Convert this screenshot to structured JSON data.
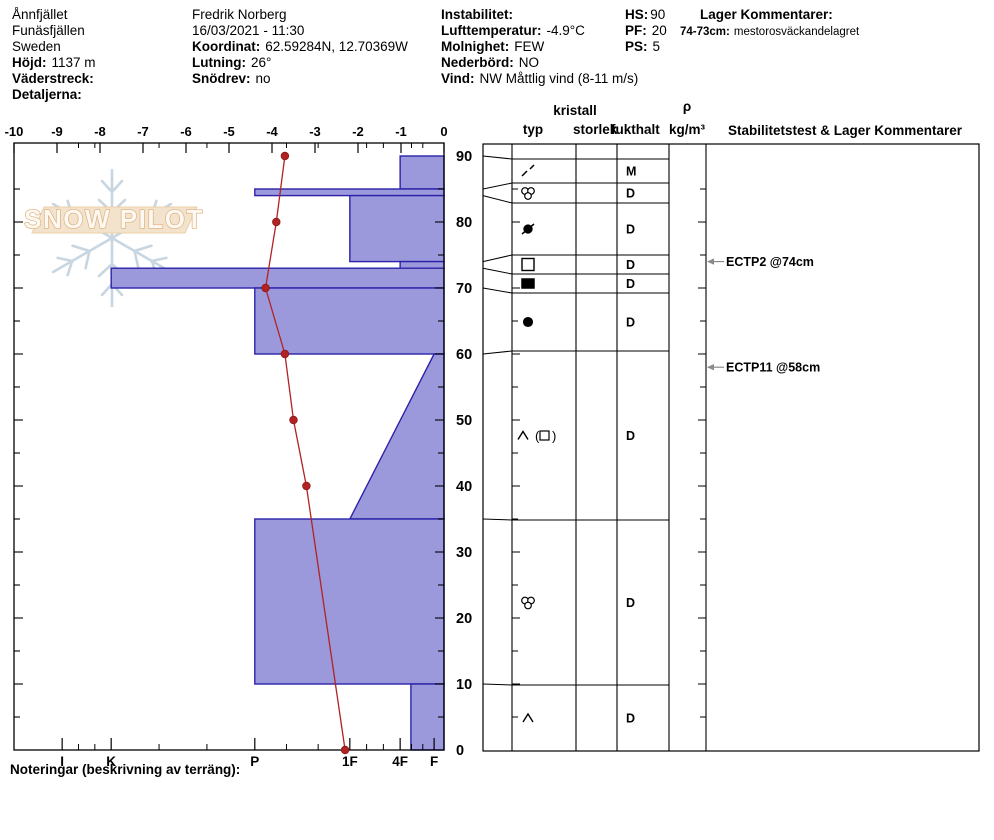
{
  "header": {
    "location": {
      "name": "Ånnfjället",
      "region": "Funäsfjällen",
      "country": "Sweden",
      "hojd_label": "Höjd:",
      "hojd_value": "1137 m",
      "vaderstreck_label": "Väderstreck:",
      "vaderstreck_value": "",
      "detaljerna_label": "Detaljerna:",
      "detaljerna_value": ""
    },
    "observer": {
      "name": "Fredrik Norberg",
      "datetime": "16/03/2021 - 11:30",
      "koordinat_label": "Koordinat:",
      "koordinat_value": "62.59284N, 12.70369W",
      "lutning_label": "Lutning:",
      "lutning_value": "26°",
      "snodrev_label": "Snödrev:",
      "snodrev_value": "no"
    },
    "conditions": {
      "instabilitet_label": "Instabilitet:",
      "instabilitet_value": "",
      "lufttemperatur_label": "Lufttemperatur:",
      "lufttemperatur_value": "-4.9°C",
      "molnighet_label": "Molnighet:",
      "molnighet_value": "FEW",
      "nederbord_label": "Nederbörd:",
      "nederbord_value": "NO",
      "vind_label": "Vind:",
      "vind_value": "NW Måttlig vind (8-11 m/s)"
    },
    "summary": {
      "hs_label": "HS:",
      "hs_value": "90",
      "pf_label": "PF:",
      "pf_value": "20",
      "ps_label": "PS:",
      "ps_value": "5"
    },
    "lager": {
      "title": "Lager Kommentarer:",
      "entry_label": "74-73cm:",
      "entry_text": "mestorosväckandelagret"
    }
  },
  "watermark": {
    "text": "SNOW PILOT"
  },
  "chart_data": {
    "type": "area",
    "title": "Snow profile: hardness layers vs depth with temperature trace",
    "depth_unit": "cm",
    "depth_max": 90,
    "temp_ticks": [
      -10,
      -9,
      -8,
      -7,
      -6,
      -5,
      -4,
      -3,
      -2,
      -1,
      0
    ],
    "depth_labels": [
      90,
      80,
      70,
      60,
      50,
      40,
      30,
      20,
      10,
      0
    ],
    "hardness_scale": [
      {
        "label": "I",
        "value": -8.88
      },
      {
        "label": "K",
        "value": -7.74
      },
      {
        "label": "P",
        "value": -4.4
      },
      {
        "label": "1F",
        "value": -2.19
      },
      {
        "label": "4F",
        "value": -1.02
      },
      {
        "label": "F",
        "value": -0.23
      }
    ],
    "layers": [
      {
        "top": 90,
        "bottom": 85,
        "hardness": "4F",
        "hv_top": -1.02,
        "hv_bottom": -1.02
      },
      {
        "top": 85,
        "bottom": 84,
        "hardness": "P",
        "hv_top": -4.4,
        "hv_bottom": -4.4
      },
      {
        "top": 84,
        "bottom": 74,
        "hardness": "1F",
        "hv_top": -2.19,
        "hv_bottom": -2.19
      },
      {
        "top": 74,
        "bottom": 73,
        "hardness": "4F",
        "hv_top": -1.02,
        "hv_bottom": -1.02
      },
      {
        "top": 73,
        "bottom": 70,
        "hardness": "K",
        "hv_top": -7.74,
        "hv_bottom": -7.74
      },
      {
        "top": 70,
        "bottom": 60,
        "hardness": "P",
        "hv_top": -4.4,
        "hv_bottom": -4.4
      },
      {
        "top": 60,
        "bottom": 35,
        "hardness": "F-1F",
        "hv_top": -0.23,
        "hv_bottom": -2.19
      },
      {
        "top": 35,
        "bottom": 10,
        "hardness": "P",
        "hv_top": -4.4,
        "hv_bottom": -4.4
      },
      {
        "top": 10,
        "bottom": 0,
        "hardness": "4F-",
        "hv_top": -0.77,
        "hv_bottom": -0.77
      }
    ],
    "temperature_profile": [
      {
        "depth": 90,
        "temp": -3.7
      },
      {
        "depth": 80,
        "temp": -3.9
      },
      {
        "depth": 70,
        "temp": -4.15
      },
      {
        "depth": 60,
        "temp": -3.7
      },
      {
        "depth": 50,
        "temp": -3.5
      },
      {
        "depth": 40,
        "temp": -3.2
      },
      {
        "depth": 0,
        "temp": -2.3
      }
    ],
    "colors": {
      "layer_fill": "#9b99dc",
      "layer_stroke": "#2c22a8",
      "temp_line": "#b22222",
      "annotation_arrow": "#8a8a8a",
      "watermark_flake": "#c8d6e2",
      "watermark_band": "#f4e3cc",
      "watermark_text_stroke": "#dcab76"
    }
  },
  "table": {
    "headers": {
      "typ": "typ",
      "kristall": "kristall",
      "storlek": "storlek",
      "fukthalt": "fukthalt",
      "rho": "ρ",
      "rho_unit": "kg/m³",
      "stability": "Stabilitetstest & Lager Kommentarer"
    },
    "rows": [
      {
        "top": 90,
        "bottom": 85,
        "row_top": 159,
        "row_bottom": 183,
        "glyph": "decomposing",
        "fukthalt": "M"
      },
      {
        "top": 85,
        "bottom": 84,
        "row_top": 183,
        "row_bottom": 203,
        "glyph": "graupel",
        "fukthalt": "D"
      },
      {
        "top": 84,
        "bottom": 74,
        "row_top": 203,
        "row_bottom": 255,
        "glyph": "rounds-slash",
        "fukthalt": "D"
      },
      {
        "top": 74,
        "bottom": 73,
        "row_top": 255,
        "row_bottom": 274,
        "glyph": "facets",
        "fukthalt": "D"
      },
      {
        "top": 73,
        "bottom": 70,
        "row_top": 274,
        "row_bottom": 293,
        "glyph": "ice",
        "fukthalt": "D"
      },
      {
        "top": 70,
        "bottom": 60,
        "row_top": 293,
        "row_bottom": 351,
        "glyph": "rounds",
        "fukthalt": "D"
      },
      {
        "top": 60,
        "bottom": 35,
        "row_top": 351,
        "row_bottom": 520,
        "glyph": "depth-hoar-facets",
        "fukthalt": "D"
      },
      {
        "top": 35,
        "bottom": 10,
        "row_top": 520,
        "row_bottom": 685,
        "glyph": "graupel",
        "fukthalt": "D"
      },
      {
        "top": 10,
        "bottom": 0,
        "row_top": 685,
        "row_bottom": 751,
        "glyph": "depth-hoar",
        "fukthalt": "D"
      }
    ],
    "stability_tests": [
      {
        "label": "ECTP2 @74cm",
        "depth": 74
      },
      {
        "label": "ECTP11 @58cm",
        "depth": 58
      }
    ]
  },
  "footer": {
    "noteringar_label": "Noteringar (beskrivning av terräng):"
  }
}
